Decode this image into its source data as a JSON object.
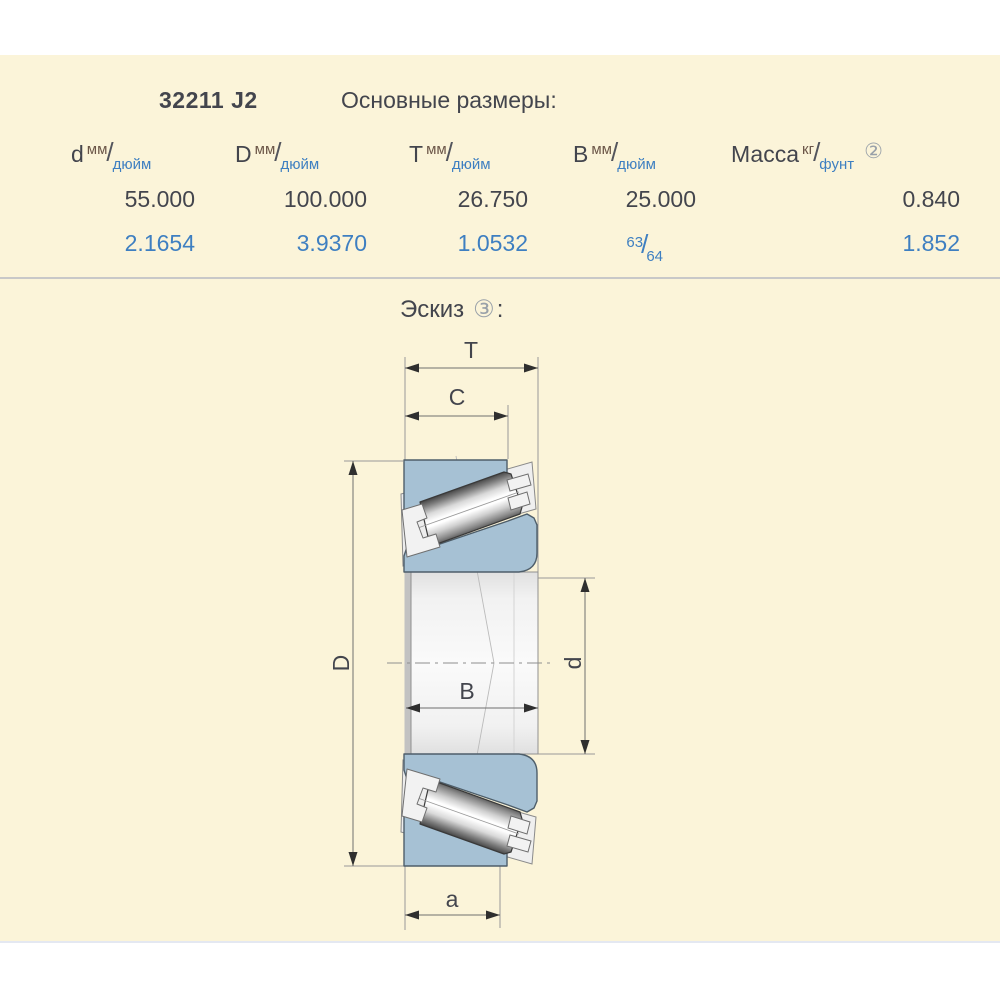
{
  "header": {
    "part_number": "32211 J2",
    "section_title": "Основные размеры:"
  },
  "table": {
    "slash": "/",
    "columns": [
      {
        "symbol": "d",
        "unit_top": "мм",
        "unit_bottom": "дюйм"
      },
      {
        "symbol": "D",
        "unit_top": "мм",
        "unit_bottom": "дюйм"
      },
      {
        "symbol": "T",
        "unit_top": "мм",
        "unit_bottom": "дюйм"
      },
      {
        "symbol": "B",
        "unit_top": "мм",
        "unit_bottom": "дюйм"
      },
      {
        "symbol": "Масса",
        "unit_top": "кг",
        "unit_bottom": "фунт",
        "note": "②"
      }
    ],
    "row_mm": {
      "d": "55.000",
      "D": "100.000",
      "T": "26.750",
      "B": "25.000",
      "mass": "0.840"
    },
    "row_inch": {
      "d": "2.1654",
      "D": "3.9370",
      "T": "1.0532",
      "B_numerator": "63",
      "B_denominator": "64",
      "mass": "1.852"
    }
  },
  "sketch": {
    "heading": "Эскиз",
    "badge": "③",
    "colon": ":",
    "dim_labels": {
      "T": "T",
      "C": "C",
      "D": "D",
      "d": "d",
      "B": "B",
      "a": "a"
    }
  },
  "colors": {
    "panel_background": "#FBF4D9",
    "dark_text": "#43454D",
    "accent_blue_text": "#3E7FC1",
    "unit_top_text": "#6B5648",
    "bearing_ring_fill": "#A6C1D4"
  }
}
